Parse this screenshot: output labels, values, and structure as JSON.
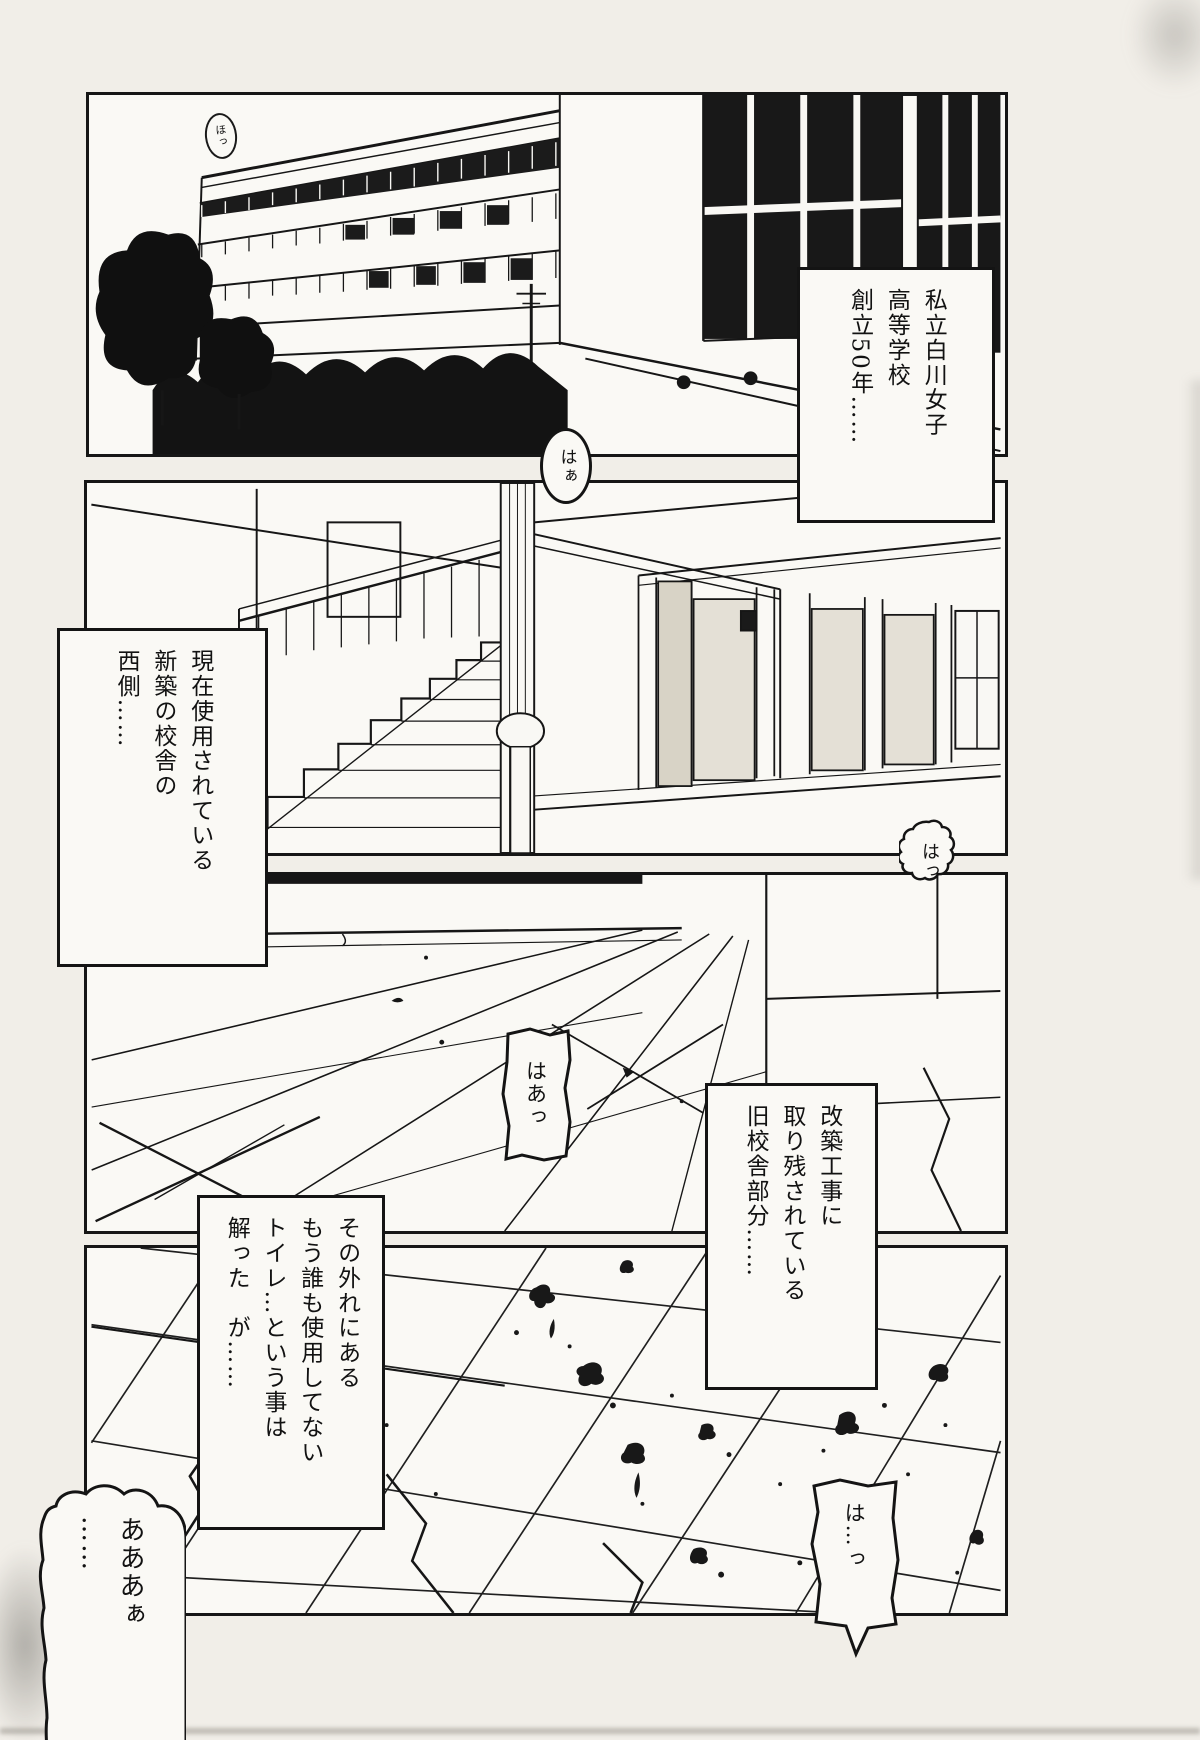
{
  "page": {
    "kind": "manga page",
    "paper_color": "#f1eee8",
    "ink_color": "#161616",
    "panel_bg": "#faf9f5"
  },
  "panels": [
    {
      "art": "school building exterior"
    },
    {
      "art": "staircase hall interior"
    },
    {
      "art": "empty corridor floor"
    },
    {
      "art": "cracked tiled floor with stains"
    }
  ],
  "captions": {
    "school": "私立白川女子\n高等学校\n創立50年……",
    "west_side": "現在使用されている\n新築の校舎の\n西側……",
    "old_building": "改築工事に\n取り残されている\n旧校舎部分……",
    "toilet": "その外れにある\nもう誰も使用してない\nトイレ…という事は\n解った　が……"
  },
  "bubbles": {
    "ho": "ほっ",
    "sigh_small": "はぁ",
    "gasp": "はっ",
    "sigh": "はあっ",
    "moan": "あああぁ\n……",
    "gasp_long": "は…っ"
  }
}
